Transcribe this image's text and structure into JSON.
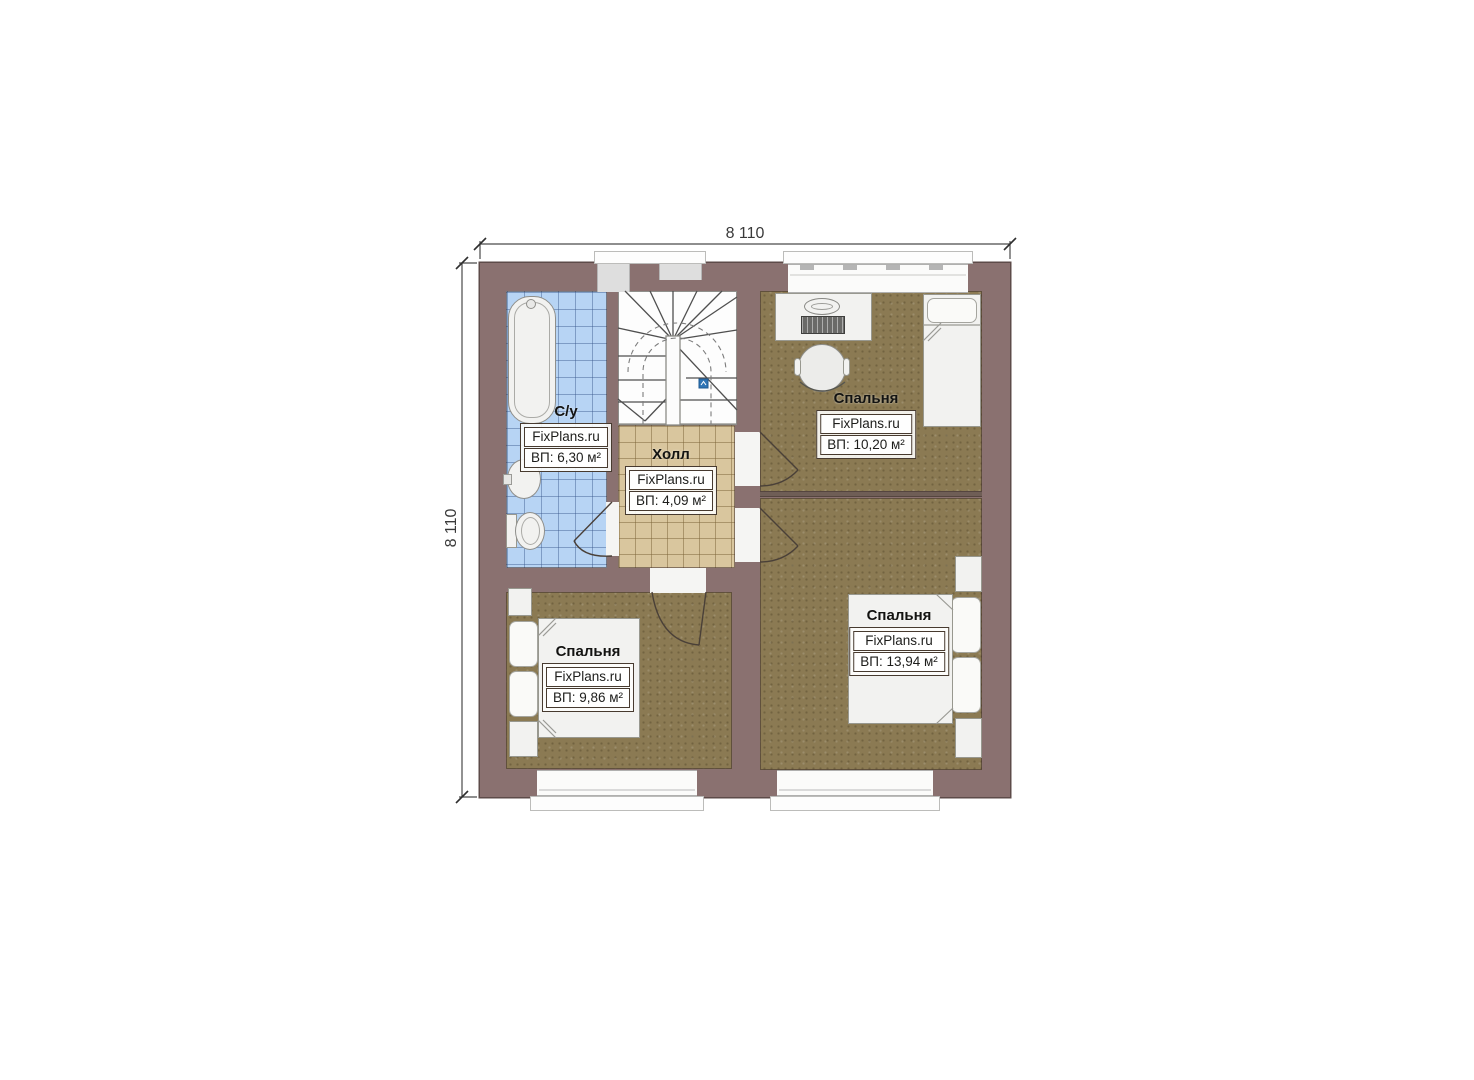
{
  "dimensions": {
    "top": "8 110",
    "left": "8 110"
  },
  "watermark": "FixPlans.ru",
  "rooms": [
    {
      "id": "bathroom",
      "name": "С/у",
      "brand": "FixPlans.ru",
      "area": "ВП: 6,30 м²"
    },
    {
      "id": "hall",
      "name": "Холл",
      "brand": "FixPlans.ru",
      "area": "ВП: 4,09 м²"
    },
    {
      "id": "bedroom-top-right",
      "name": "Спальня",
      "brand": "FixPlans.ru",
      "area": "ВП: 10,20 м²"
    },
    {
      "id": "bedroom-bottom-left",
      "name": "Спальня",
      "brand": "FixPlans.ru",
      "area": "ВП: 9,86 м²"
    },
    {
      "id": "bedroom-bottom-right",
      "name": "Спальня",
      "brand": "FixPlans.ru",
      "area": "ВП: 13,94 м²"
    }
  ],
  "colors": {
    "wall": "#8a7170",
    "bathroom_tile": "#b7d4f4",
    "hall_tile": "#d9c69e",
    "carpet": "#8b7a53",
    "stair_marker_blue": "#2e74b5",
    "furniture": "#f2f2f0"
  }
}
